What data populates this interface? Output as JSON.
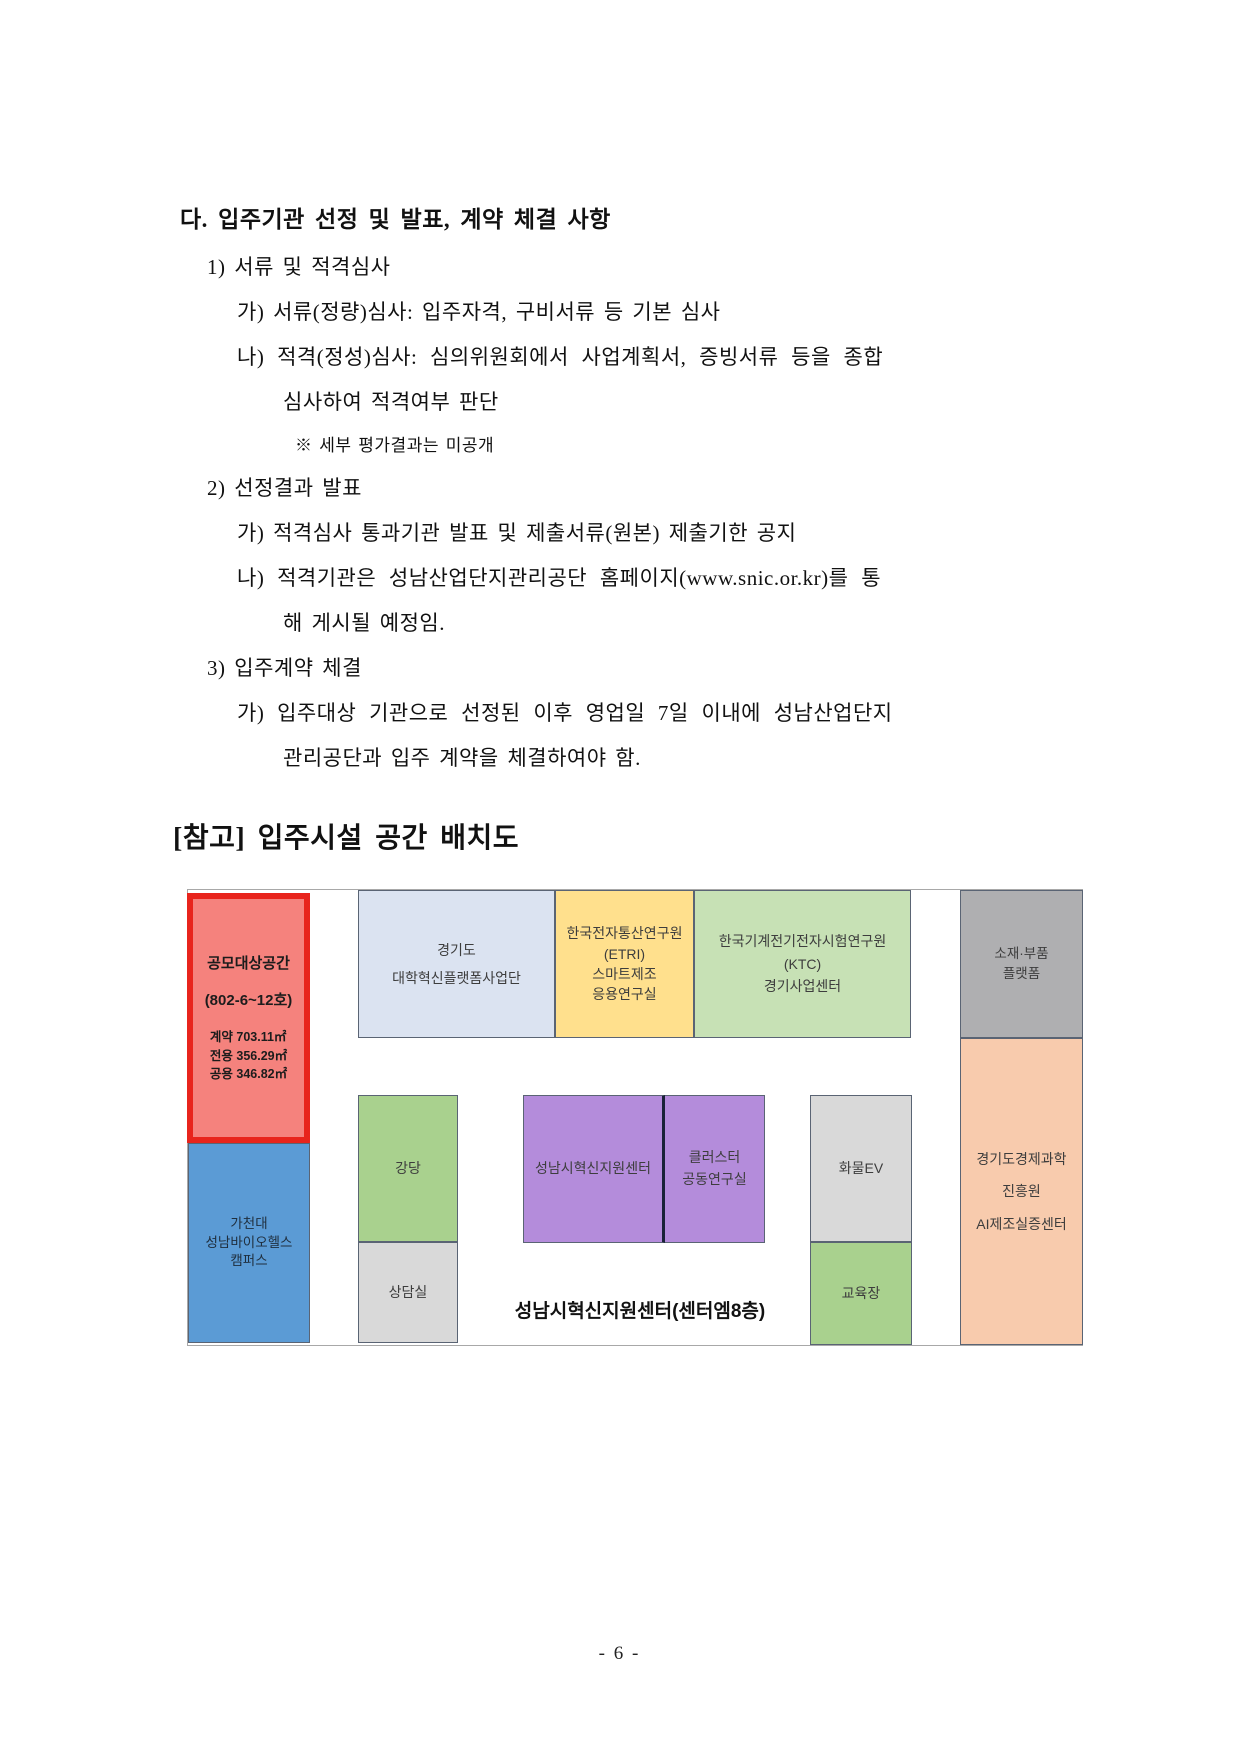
{
  "document": {
    "section_heading": "다. 입주기관 선정 및 발표, 계약 체결 사항",
    "lines": [
      {
        "text": "1) 서류 및 적격심사"
      },
      {
        "text": "가) 서류(정량)심사: 입주자격, 구비서류 등 기본 심사"
      },
      {
        "text": "나) 적격(정성)심사: 심의위원회에서 사업계획서, 증빙서류 등을 종합"
      },
      {
        "text": "심사하여 적격여부 판단"
      },
      {
        "text": "※ 세부 평가결과는 미공개"
      },
      {
        "text": "2) 선정결과 발표"
      },
      {
        "text": "가) 적격심사 통과기관 발표 및 제출서류(원본) 제출기한 공지"
      },
      {
        "text": "나) 적격기관은 성남산업단지관리공단 홈페이지(www.snic.or.kr)를 통"
      },
      {
        "text": "해 게시될 예정임."
      },
      {
        "text": "3) 입주계약 체결"
      },
      {
        "text": "가) 입주대상 기관으로 선정된 이후 영업일 7일 이내에 성남산업단지"
      },
      {
        "text": "관리공단과 입주 계약을 체결하여야 함."
      }
    ],
    "reference_heading": "[참고] 입주시설 공간 배치도",
    "page_number": "- 6 -"
  },
  "floor_plan": {
    "caption": "성남시혁신지원센터(센터엠8층)",
    "target_space": {
      "title": "공모대상공간",
      "unit": "(802-6~12호)",
      "areas": "계약 703.11㎡\n전용 356.29㎡\n공용 346.82㎡"
    },
    "rooms": {
      "gachon": "가천대\n성남바이오헬스\n캠퍼스",
      "gyeonggi_univ": "경기도\n대학혁신플랫폼사업단",
      "etri": "한국전자통산연구원\n(ETRI)\n스마트제조\n응용연구실",
      "ktc": "한국기계전기전자시험연구원\n(KTC)\n경기사업센터",
      "sojae": "소재·부품\n플랫폼",
      "gep": "경기도경제과학\n진흥원\nAI제조실증센터",
      "auditorium": "강당",
      "counsel": "상담실",
      "innovation": "성남시혁신지원센터",
      "cluster": "클러스터\n공동연구실",
      "cargo_ev": "화물EV",
      "training": "교육장"
    },
    "colors": {
      "target_border": "#e8241c",
      "target_fill": "#f5827d",
      "gachon_fill": "#5b9bd5",
      "gyeonggi_univ_fill": "#dbe3f1",
      "etri_fill": "#ffe08d",
      "ktc_fill": "#c7e1b5",
      "sojae_fill": "#afafb1",
      "gep_fill": "#f8cbad",
      "green_fill": "#a9d18e",
      "gray_fill": "#d9d9d9",
      "purple_fill": "#b48cdb",
      "purple_divider": "#1a2238"
    }
  }
}
